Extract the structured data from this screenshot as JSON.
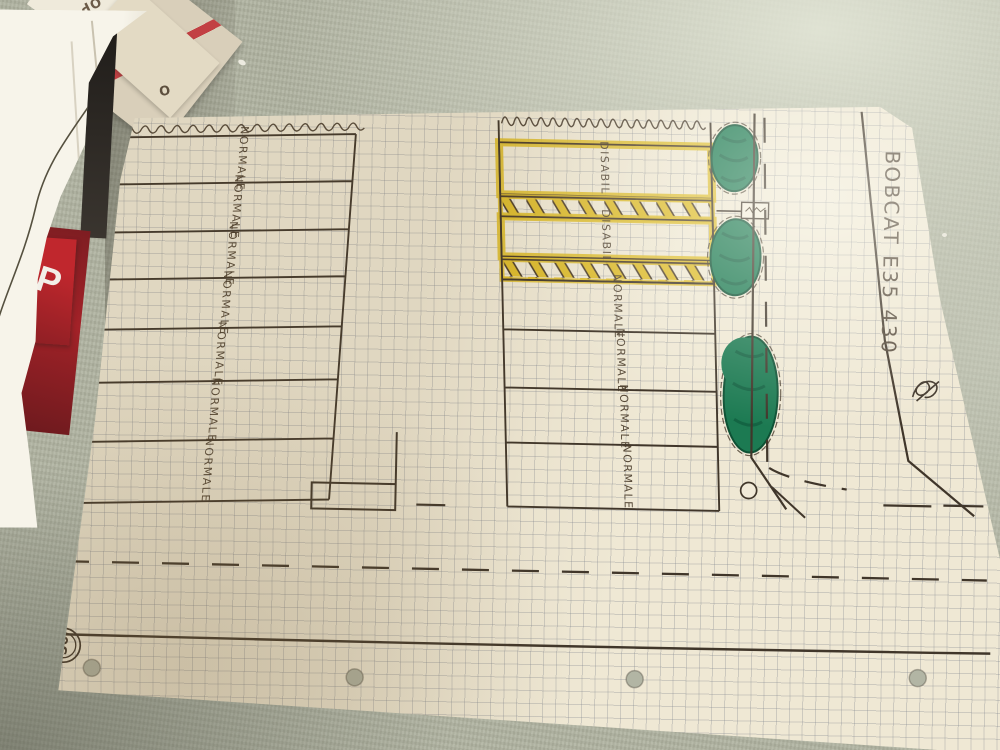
{
  "annotations": {
    "machine_note": "BOBCAT E35 430",
    "speed_limit_sign": "50"
  },
  "left_block": {
    "stalls": [
      "NORMALE",
      "NORMALE",
      "NORMALE",
      "NORMALE",
      "NORMALE",
      "NORMALE",
      "NORMALE"
    ]
  },
  "middle_block": {
    "disabled": [
      "DISABILI",
      "DISABILI"
    ],
    "normal": [
      "NORMALE",
      "NORMALE",
      "NORMALE",
      "NORMALE"
    ]
  },
  "stack": {
    "op": "OP",
    "o": "O",
    "p": "P"
  },
  "colors": {
    "ink": "#40362a",
    "highlighter_yellow": "#ddbc2e",
    "bush_green": "#1c7a52",
    "paper": "#efe8d4",
    "table_fabric": "#b0b3a1",
    "magazine_red": "#b5262b"
  }
}
